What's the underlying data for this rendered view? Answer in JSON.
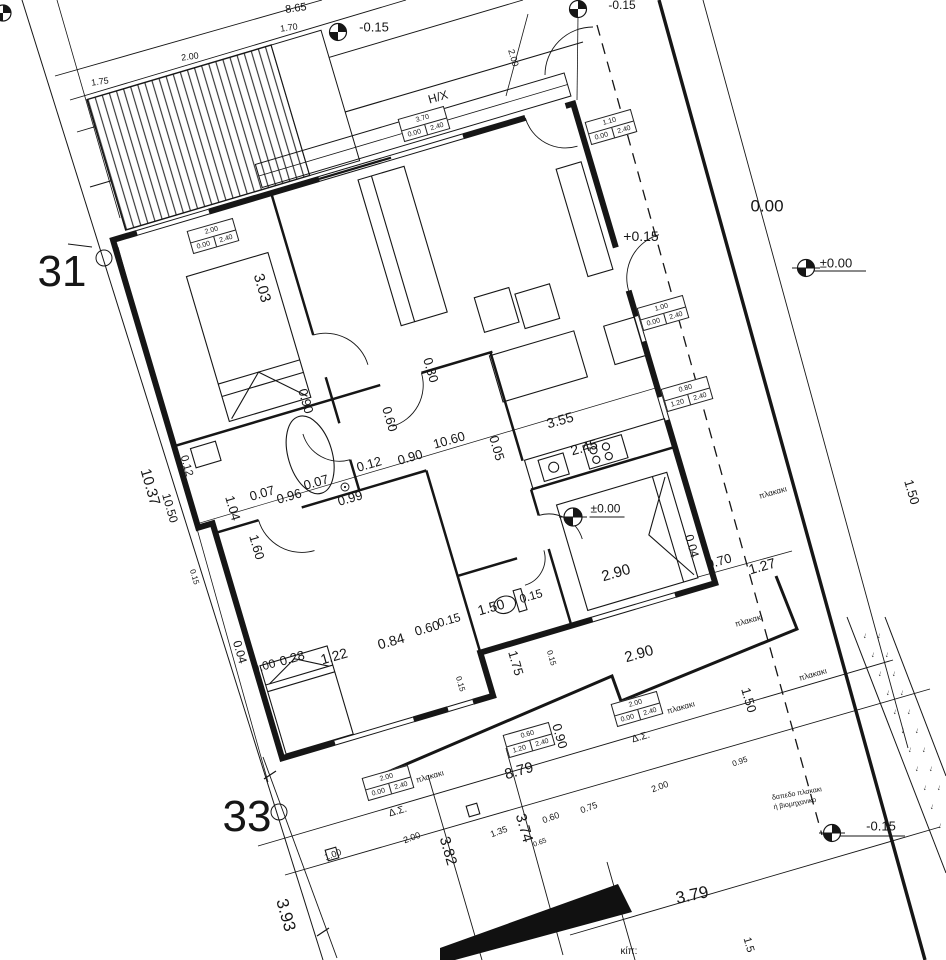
{
  "drawing": {
    "type": "architectural floor plan / site plan",
    "parcel_numbers": [
      "31",
      "33"
    ],
    "colors": {
      "ink": "#161616",
      "background": "#ffffff"
    }
  },
  "garden": {
    "arrow": "↓",
    "rows": 17
  },
  "window_tags": [
    {
      "w": "2.00",
      "a": "0.00",
      "b": "2.40",
      "x": 213,
      "y": 236,
      "r": -16
    },
    {
      "w": "3.70",
      "a": "0.00",
      "b": "2.40",
      "x": 424,
      "y": 124,
      "r": -16
    },
    {
      "w": "1.10",
      "a": "0.00",
      "b": "2.40",
      "x": 611,
      "y": 127,
      "r": -16
    },
    {
      "w": "1.00",
      "a": "0.00",
      "b": "2.40",
      "x": 663,
      "y": 313,
      "r": -16
    },
    {
      "w": "0.80",
      "a": "1.20",
      "b": "2.40",
      "x": 687,
      "y": 394,
      "r": -16
    },
    {
      "w": "2.00",
      "a": "0.00",
      "b": "2.40",
      "x": 637,
      "y": 709,
      "r": -16
    },
    {
      "w": "0.60",
      "a": "1.20",
      "b": "2.40",
      "x": 529,
      "y": 740,
      "r": -16
    },
    {
      "w": "2.00",
      "a": "0.00",
      "b": "2.40",
      "x": 388,
      "y": 783,
      "r": -16
    }
  ],
  "annotations": [
    {
      "t": "8.65",
      "x": 296,
      "y": 9,
      "r": -8,
      "s": 11
    },
    {
      "t": "1.70",
      "x": 289,
      "y": 28,
      "r": -8,
      "s": 9
    },
    {
      "t": "2.00",
      "x": 190,
      "y": 57,
      "r": -8,
      "s": 9
    },
    {
      "t": "1.75",
      "x": 100,
      "y": 82,
      "r": -8,
      "s": 9
    },
    {
      "t": "-0.15",
      "x": 374,
      "y": 27,
      "r": 0,
      "s": 13,
      "n": "elevation-label"
    },
    {
      "t": "-0.15",
      "x": 622,
      "y": 5,
      "r": 0,
      "s": 12,
      "n": "elevation-label"
    },
    {
      "t": "2.00",
      "x": 513,
      "y": 58,
      "r": 74,
      "s": 9
    },
    {
      "t": "H/X",
      "x": 438,
      "y": 97,
      "r": -16,
      "s": 12,
      "n": "area-label"
    },
    {
      "t": "+0.15",
      "x": 641,
      "y": 236,
      "r": 0,
      "s": 14,
      "n": "elevation-label"
    },
    {
      "t": "0.00",
      "x": 767,
      "y": 206,
      "r": 0,
      "s": 17,
      "n": "elevation-label"
    },
    {
      "t": "±0.00",
      "x": 836,
      "y": 263,
      "r": 0,
      "s": 13,
      "n": "elevation-label"
    },
    {
      "t": "31",
      "x": 62,
      "y": 272,
      "r": 0,
      "s": 44,
      "n": "parcel-number"
    },
    {
      "t": "3.03",
      "x": 262,
      "y": 288,
      "r": 74,
      "s": 15
    },
    {
      "t": "10.37",
      "x": 150,
      "y": 487,
      "r": 74,
      "s": 15
    },
    {
      "t": "10.50",
      "x": 170,
      "y": 508,
      "r": 74,
      "s": 12
    },
    {
      "t": "0.12",
      "x": 186,
      "y": 466,
      "r": 74,
      "s": 11
    },
    {
      "t": "0.15",
      "x": 194,
      "y": 577,
      "r": 74,
      "s": 8
    },
    {
      "t": "0.90",
      "x": 306,
      "y": 401,
      "r": 74,
      "s": 13
    },
    {
      "t": "0.60",
      "x": 390,
      "y": 419,
      "r": 74,
      "s": 13
    },
    {
      "t": "0.30",
      "x": 431,
      "y": 370,
      "r": 74,
      "s": 13
    },
    {
      "t": "0.12",
      "x": 369,
      "y": 464,
      "r": -16,
      "s": 13
    },
    {
      "t": "0.90",
      "x": 410,
      "y": 457,
      "r": -16,
      "s": 13
    },
    {
      "t": "10.60",
      "x": 449,
      "y": 440,
      "r": -16,
      "s": 13
    },
    {
      "t": "0.05",
      "x": 497,
      "y": 448,
      "r": 74,
      "s": 13
    },
    {
      "t": "3.55",
      "x": 560,
      "y": 420,
      "r": -16,
      "s": 14
    },
    {
      "t": "2.45",
      "x": 584,
      "y": 447,
      "r": -16,
      "s": 14
    },
    {
      "t": "1.04",
      "x": 233,
      "y": 508,
      "r": 74,
      "s": 13
    },
    {
      "t": "1.60",
      "x": 257,
      "y": 547,
      "r": 74,
      "s": 13
    },
    {
      "t": "0.07",
      "x": 262,
      "y": 493,
      "r": -16,
      "s": 13
    },
    {
      "t": "0.96",
      "x": 289,
      "y": 496,
      "r": -16,
      "s": 13
    },
    {
      "t": "0.07",
      "x": 316,
      "y": 482,
      "r": -16,
      "s": 13
    },
    {
      "t": "0.99",
      "x": 350,
      "y": 498,
      "r": -16,
      "s": 13
    },
    {
      "t": "±0.00",
      "x": 607,
      "y": 510,
      "r": 0,
      "s": 12,
      "u": 1,
      "n": "elevation-label"
    },
    {
      "t": "0.04",
      "x": 692,
      "y": 546,
      "r": 74,
      "s": 12
    },
    {
      "t": "0.70",
      "x": 719,
      "y": 561,
      "r": -16,
      "s": 13
    },
    {
      "t": "1.27",
      "x": 762,
      "y": 566,
      "r": -16,
      "s": 14
    },
    {
      "t": "2.90",
      "x": 616,
      "y": 573,
      "r": -16,
      "s": 15
    },
    {
      "t": "2.90",
      "x": 639,
      "y": 654,
      "r": -16,
      "s": 15
    },
    {
      "t": "πλακακι",
      "x": 773,
      "y": 493,
      "r": -16,
      "s": 8,
      "n": "area-label"
    },
    {
      "t": "πλακακι",
      "x": 749,
      "y": 621,
      "r": -16,
      "s": 8,
      "n": "area-label"
    },
    {
      "t": "πλακακι",
      "x": 813,
      "y": 675,
      "r": -16,
      "s": 8,
      "n": "area-label"
    },
    {
      "t": "πλακακι",
      "x": 681,
      "y": 708,
      "r": -16,
      "s": 8,
      "n": "area-label"
    },
    {
      "t": "πλακακι",
      "x": 430,
      "y": 777,
      "r": -16,
      "s": 8,
      "n": "area-label"
    },
    {
      "t": "0.04",
      "x": 240,
      "y": 652,
      "r": 74,
      "s": 12
    },
    {
      "t": "0.00",
      "x": 264,
      "y": 666,
      "r": -16,
      "s": 12
    },
    {
      "t": "0.28",
      "x": 292,
      "y": 658,
      "r": -16,
      "s": 13
    },
    {
      "t": "1.22",
      "x": 334,
      "y": 656,
      "r": -16,
      "s": 14
    },
    {
      "t": "0.84",
      "x": 391,
      "y": 641,
      "r": -16,
      "s": 14
    },
    {
      "t": "0.60",
      "x": 427,
      "y": 628,
      "r": -16,
      "s": 13
    },
    {
      "t": "0.15",
      "x": 449,
      "y": 620,
      "r": -16,
      "s": 12
    },
    {
      "t": "1.50",
      "x": 491,
      "y": 607,
      "r": -16,
      "s": 14
    },
    {
      "t": "0.15",
      "x": 531,
      "y": 596,
      "r": -16,
      "s": 12
    },
    {
      "t": "1.75",
      "x": 516,
      "y": 663,
      "r": 74,
      "s": 13
    },
    {
      "t": "0.15",
      "x": 551,
      "y": 658,
      "r": 74,
      "s": 8
    },
    {
      "t": "0.15",
      "x": 460,
      "y": 684,
      "r": 74,
      "s": 8
    },
    {
      "t": "0.90",
      "x": 560,
      "y": 736,
      "r": 74,
      "s": 13
    },
    {
      "t": "8.79",
      "x": 519,
      "y": 771,
      "r": -16,
      "s": 15
    },
    {
      "t": "Δ.Σ.",
      "x": 641,
      "y": 738,
      "r": -16,
      "s": 10,
      "n": "area-label"
    },
    {
      "t": "Δ.Σ.",
      "x": 398,
      "y": 812,
      "r": -16,
      "s": 10,
      "n": "area-label"
    },
    {
      "t": "33",
      "x": 247,
      "y": 817,
      "r": 0,
      "s": 44,
      "n": "parcel-number"
    },
    {
      "t": "3.93",
      "x": 286,
      "y": 915,
      "r": 74,
      "s": 17
    },
    {
      "t": "3.82",
      "x": 448,
      "y": 851,
      "r": 74,
      "s": 15
    },
    {
      "t": "3.74",
      "x": 524,
      "y": 828,
      "r": 74,
      "s": 15
    },
    {
      "t": "1.00",
      "x": 333,
      "y": 855,
      "r": -20,
      "s": 9
    },
    {
      "t": "2.00",
      "x": 412,
      "y": 838,
      "r": -20,
      "s": 9
    },
    {
      "t": "1.35",
      "x": 499,
      "y": 832,
      "r": -20,
      "s": 9
    },
    {
      "t": "0.60",
      "x": 551,
      "y": 818,
      "r": -20,
      "s": 9
    },
    {
      "t": "0.75",
      "x": 589,
      "y": 808,
      "r": -20,
      "s": 9
    },
    {
      "t": "0.65",
      "x": 540,
      "y": 843,
      "r": -20,
      "s": 7
    },
    {
      "t": "2.00",
      "x": 660,
      "y": 787,
      "r": -20,
      "s": 9
    },
    {
      "t": "0.95",
      "x": 740,
      "y": 762,
      "r": -20,
      "s": 8
    },
    {
      "t": "3.79",
      "x": 692,
      "y": 895,
      "r": -12,
      "s": 17
    },
    {
      "t": "-0.15",
      "x": 881,
      "y": 826,
      "r": 0,
      "s": 13,
      "n": "elevation-label"
    },
    {
      "t": "δαπεδο πλακακι",
      "x": 797,
      "y": 794,
      "r": -10,
      "s": 7,
      "n": "area-label"
    },
    {
      "t": "ή βιομηχανικο",
      "x": 795,
      "y": 804,
      "r": -10,
      "s": 7,
      "n": "area-label"
    },
    {
      "t": "1.50",
      "x": 749,
      "y": 700,
      "r": 74,
      "s": 13
    },
    {
      "t": "1.50",
      "x": 912,
      "y": 492,
      "r": 74,
      "s": 13
    },
    {
      "t": "1.5",
      "x": 748,
      "y": 945,
      "r": 74,
      "s": 11
    },
    {
      "t": "κίπ:",
      "x": 629,
      "y": 952,
      "r": 0,
      "s": 10,
      "n": "area-label"
    }
  ]
}
